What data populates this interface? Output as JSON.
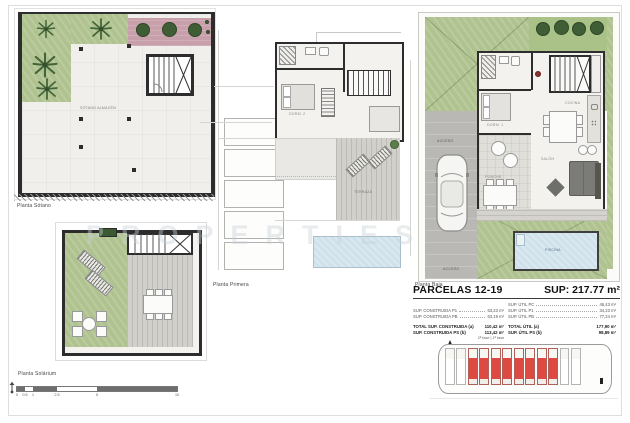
{
  "sheet": {
    "watermark": "PROPERTIES"
  },
  "plans": {
    "sotano": {
      "label": "Planta Sótano",
      "room_label": "SÓTANO ALMACÉN"
    },
    "solarium": {
      "label": "Planta Solárium"
    },
    "primera": {
      "label": "Planta Primera",
      "rooms": {
        "dorm": "DORM. 2",
        "terraza": "TERRAZA"
      }
    },
    "baja": {
      "label": "Planta Baja",
      "rooms": {
        "dorm1": "DORM. 1",
        "cocina": "COCINA",
        "salon": "SALÓN",
        "porche": "PORCHE",
        "acceso_top": "ACCESO",
        "acceso_bottom": "ACCESO",
        "piscina": "PISCINA"
      }
    }
  },
  "scalebar": {
    "ticks": [
      "0",
      "0.5",
      "1",
      "2.5",
      "5",
      "10"
    ]
  },
  "summary": {
    "title": "PARCELAS 12-19",
    "total_sup": "SUP: 217.77 m²",
    "rows": {
      "util_pc_label": "SUP. ÚTIL PC",
      "util_pc_value": "46,43 m²",
      "cons_p1_label": "SUP. CONSTRUIDA P1",
      "cons_p1_value": "63,23 m²",
      "util_p1_label": "SUP. ÚTIL P1",
      "util_p1_value": "34,23 m²",
      "cons_pb_label": "SUP. CONSTRUIDA PB",
      "cons_pb_value": "63,19 m²",
      "util_pb_label": "SUP. ÚTIL PB",
      "util_pb_value": "77,24 m²"
    },
    "totals": {
      "cons_total_label": "TOTAL SUP. CONSTRUIDA (a)",
      "cons_total_value": "110,42 m²",
      "util_total_label": "TOTAL ÚTIL (a)",
      "util_total_value": "177,90 m²",
      "cons_ps_label": "SUP. CONSTRUIDA PS (b)",
      "cons_ps_value": "113,42 m²",
      "util_ps_label": "SUP. ÚTIL PS (b)",
      "util_ps_value": "98,89 m²"
    },
    "footnote": "2ª fase | 1ª fase"
  },
  "siteplan": {
    "units_total": 12,
    "units_highlighted": 8,
    "highlight_color": "#dd4a41"
  },
  "colors": {
    "wall": "#2d2d2d",
    "garden_green": "#b2c693",
    "pavement_pink": "#c8a0ab",
    "pool_blue": "#cfe1eb",
    "highlight_red": "#dd4a41"
  }
}
